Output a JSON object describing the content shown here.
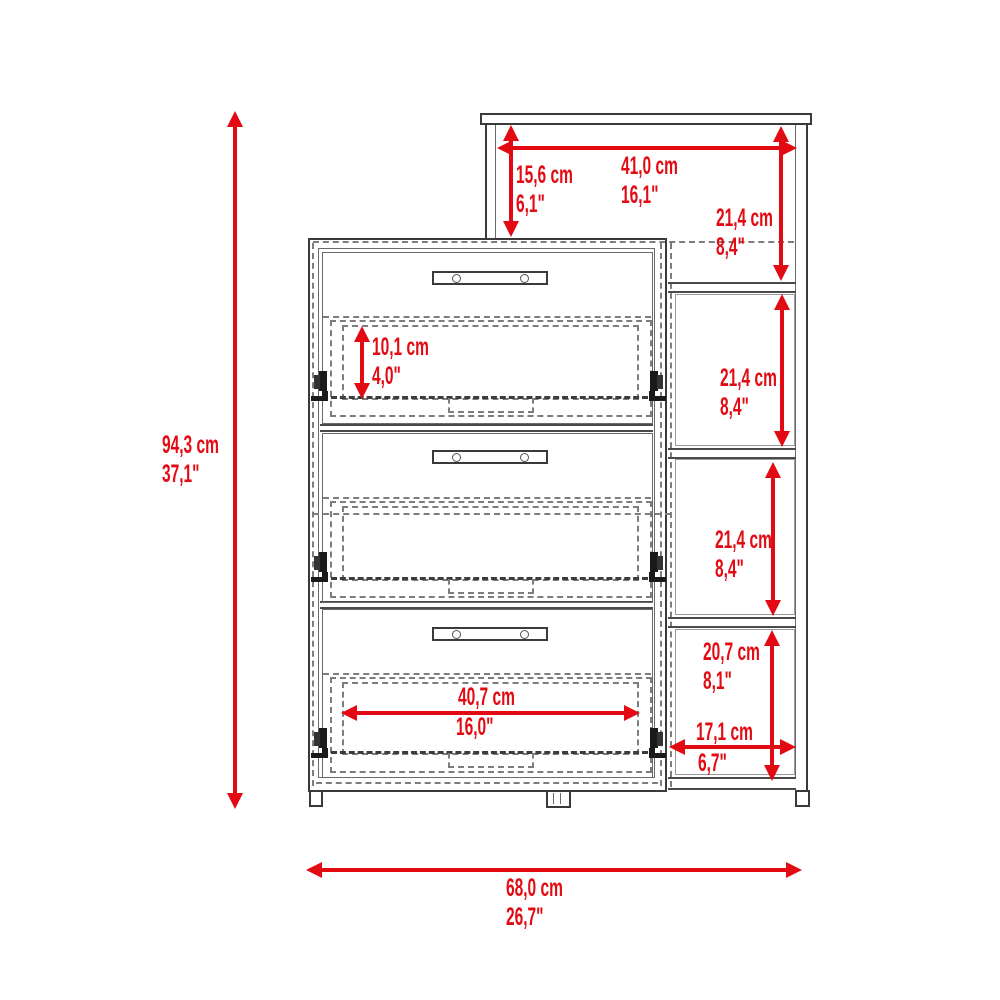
{
  "colors": {
    "dimension_red": "#e30b13",
    "outline_dark": "#3a3a3a",
    "outline_gray": "#7d7d7d",
    "background": "#ffffff"
  },
  "dimensions": {
    "overall_height": {
      "cm": "94,3 cm",
      "in": "37,1\""
    },
    "overall_width": {
      "cm": "68,0 cm",
      "in": "26,7\""
    },
    "top_shelf_offset": {
      "cm": "15,6 cm",
      "in": "6,1\""
    },
    "top_shelf_width": {
      "cm": "41,0 cm",
      "in": "16,1\""
    },
    "side_compartment_1": {
      "cm": "21,4 cm",
      "in": "8,4\""
    },
    "side_compartment_2": {
      "cm": "21,4 cm",
      "in": "8,4\""
    },
    "side_compartment_3": {
      "cm": "21,4 cm",
      "in": "8,4\""
    },
    "side_compartment_4_height": {
      "cm": "20,7 cm",
      "in": "8,1\""
    },
    "side_compartment_4_width": {
      "cm": "17,1 cm",
      "in": "6,7\""
    },
    "drawer_opening_height": {
      "cm": "10,1 cm",
      "in": "4,0\""
    },
    "drawer_width": {
      "cm": "40,7 cm",
      "in": "16,0\""
    }
  }
}
